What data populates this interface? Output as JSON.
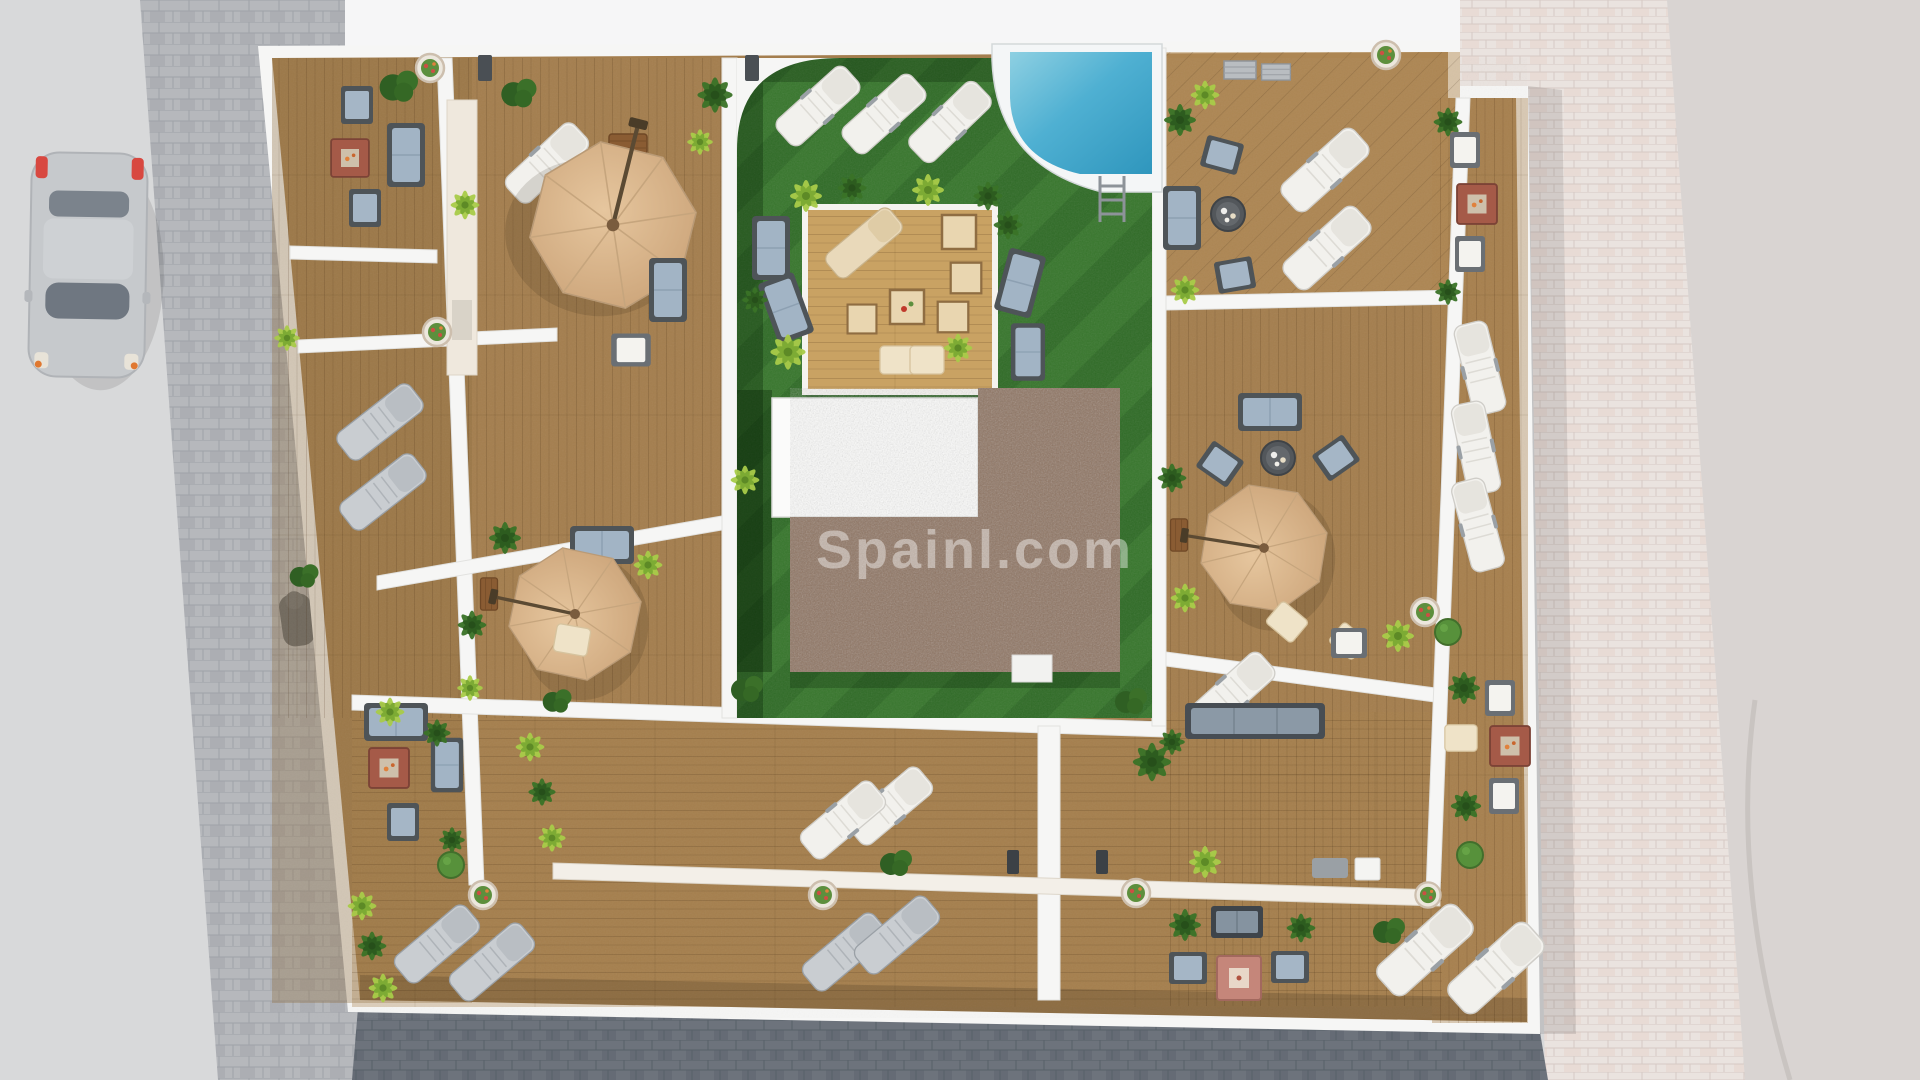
{
  "scene": {
    "title": "Aerial 3D architectural render of a rooftop terrace plan",
    "watermark": {
      "text": "Spainl.com",
      "color": "#ffffff",
      "opacity": 0.42
    },
    "setting": {
      "left": "street with parked car and gray block-paved sidewalk",
      "right": "light stone promenade paving",
      "bottom": "dark cobblestone pavement",
      "center": "apartment roof with private wooden deck terraces around a communal landscaped courtyard"
    },
    "courtyard": {
      "features": [
        "artificial turf lawn",
        "swimming pool with ladder",
        "timber pergola lounge deck",
        "white stairwell roof",
        "brown gravel roof section"
      ]
    },
    "objects": {
      "parasols": 3,
      "sun_loungers": 21,
      "lounge_sofas": 15,
      "armchairs": 14,
      "fire_tables": 5,
      "round_coffee_tables": 2,
      "swimming_pool": 1,
      "pool_ladder": 1,
      "parked_car": 1,
      "scooter": 1,
      "wall_planters": 8,
      "vegetation": "numerous palms, shrubs and clipped box balls"
    },
    "palette": {
      "deck_wood": "#a47e4e",
      "pergola_wood": "#c9a263",
      "turf_light": "#37762c",
      "turf_dark": "#2f6b26",
      "gravel_roof": "#8f7563",
      "walls": "#f6f6f5",
      "street": "#d8d9da",
      "sidewalk": "#b6b8bc",
      "promenade": "#eae3df",
      "dark_pavement": "#6d737c",
      "parasol": "#d9b58d",
      "pool_water": "#3fa3c8",
      "cushion_blue": "#a2b4c5",
      "fire_table": "#a55a48"
    }
  }
}
